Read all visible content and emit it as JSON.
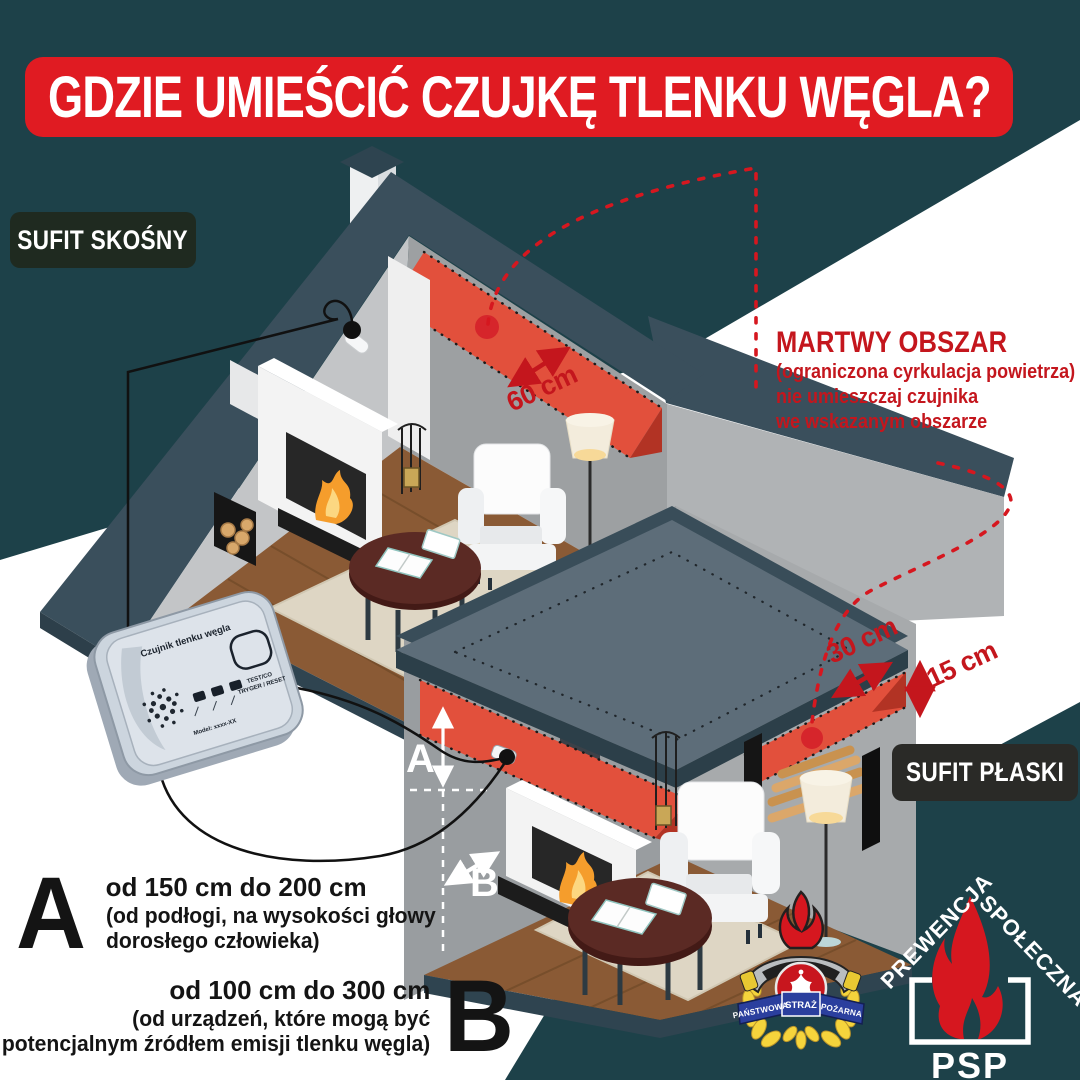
{
  "title": "GDZIE UMIEŚCIĆ CZUJKĘ TLENKU WĘGLA?",
  "labels": {
    "sloped": "SUFIT SKOŚNY",
    "flat": "SUFIT PŁASKI"
  },
  "dead_zone": {
    "heading": "MARTWY OBSZAR",
    "line1": "(ograniczona cyrkulacja powietrza)",
    "line2": "nie umieszczaj czujnika",
    "line3": "we wskazanym obszarze"
  },
  "measurements": {
    "roof_band": "60 cm",
    "ceiling_band": "30 cm",
    "band_height": "15 cm"
  },
  "point_a": {
    "letter": "A",
    "marker": "A",
    "prefix": "od",
    "value1": "150 cm",
    "middle": "do",
    "value2": "200 cm",
    "sub1": "(od podłogi, na wysokości głowy",
    "sub2": "dorosłego człowieka)"
  },
  "point_b": {
    "letter": "B",
    "marker": "B",
    "prefix": "od",
    "value1": "100 cm",
    "middle": "do",
    "value2": "300 cm",
    "sub1": "(od urządzeń, które mogą być",
    "sub2": "potencjalnym źródłem emisji tlenku węgla)"
  },
  "device": {
    "title": "Czujnik tlenku węgla",
    "model": "Model: xxxx-XX",
    "button_line1": "TEST/CO",
    "button_line2": "TRYGER / RESET"
  },
  "logos": {
    "badge_left": "PAŃSTWOWA",
    "badge_center": "STRAŻ",
    "badge_right": "POŻARNA",
    "psp_left": "PREWENCJA",
    "psp_right": "SPOŁECZNA",
    "psp": "PSP"
  },
  "colors": {
    "background_teal": "#1d4149",
    "banner_red": "#e01b22",
    "accent_red": "#c4161d",
    "dead_zone_band": "#e2503c",
    "roof_slate": "#3a4f5c"
  }
}
